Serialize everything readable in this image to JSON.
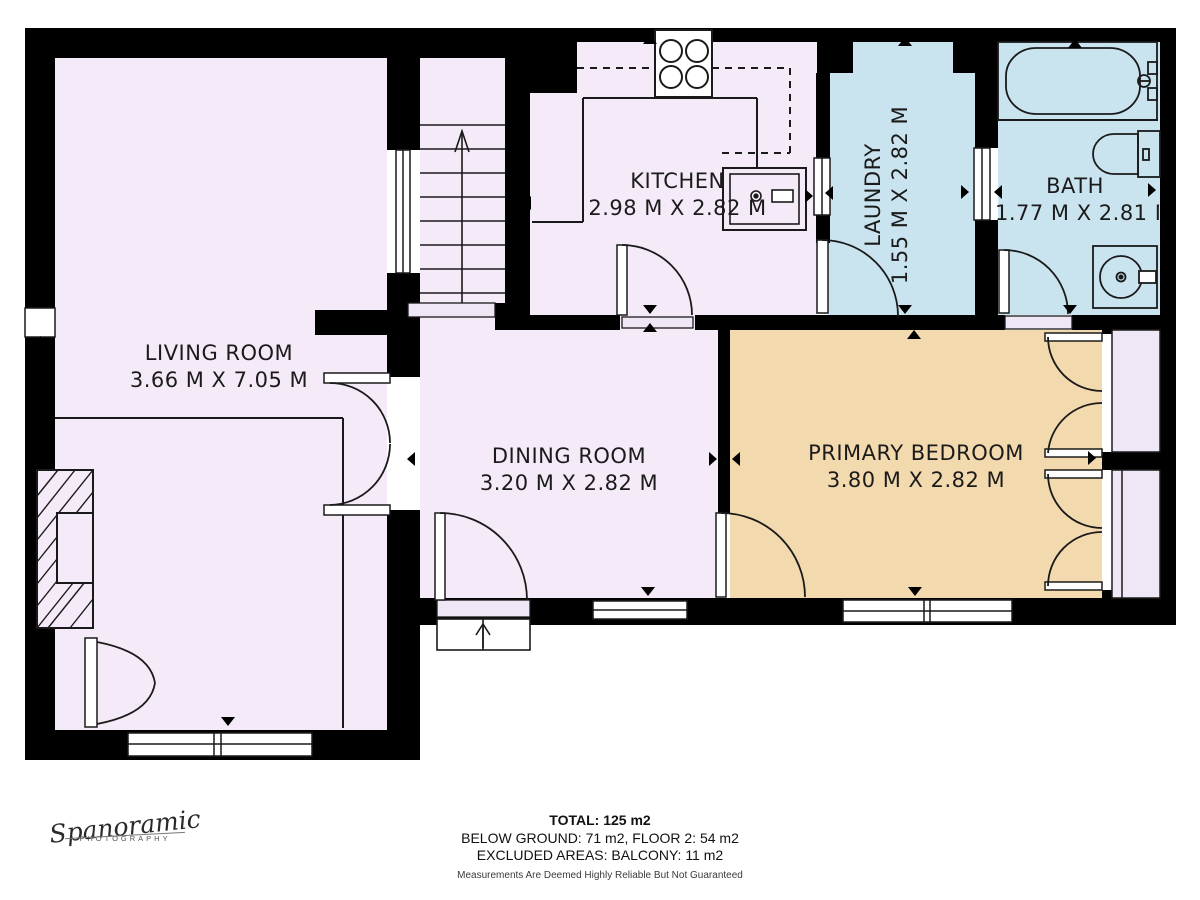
{
  "rooms": [
    {
      "name": "LIVING ROOM",
      "dims": "3.66 M X 7.05 M"
    },
    {
      "name": "KITCHEN",
      "dims": "2.98 M X 2.82 M"
    },
    {
      "name": "LAUNDRY",
      "dims": "1.55 M X 2.82 M"
    },
    {
      "name": "BATH",
      "dims": "1.77 M X 2.81 M"
    },
    {
      "name": "DINING ROOM",
      "dims": "3.20 M X 2.82 M"
    },
    {
      "name": "PRIMARY BEDROOM",
      "dims": "3.80 M X 2.82 M"
    }
  ],
  "summary": {
    "total": "TOTAL: 125 m2",
    "areas": "BELOW GROUND: 71 m2, FLOOR 2: 54 m2",
    "excluded": "EXCLUDED AREAS: BALCONY: 11 m2",
    "disclaimer": "Measurements Are Deemed Highly Reliable But Not Guaranteed"
  },
  "branding": {
    "name": "Spanoramic",
    "tagline": "PHOTOGRAPHY"
  },
  "colors": {
    "room": "#f5ebf8",
    "wet": "#c9e4ef",
    "bedroom": "#f3d9ae",
    "balcony": "#efe7f6",
    "wall": "#000000",
    "line": "#1a1a1a"
  }
}
